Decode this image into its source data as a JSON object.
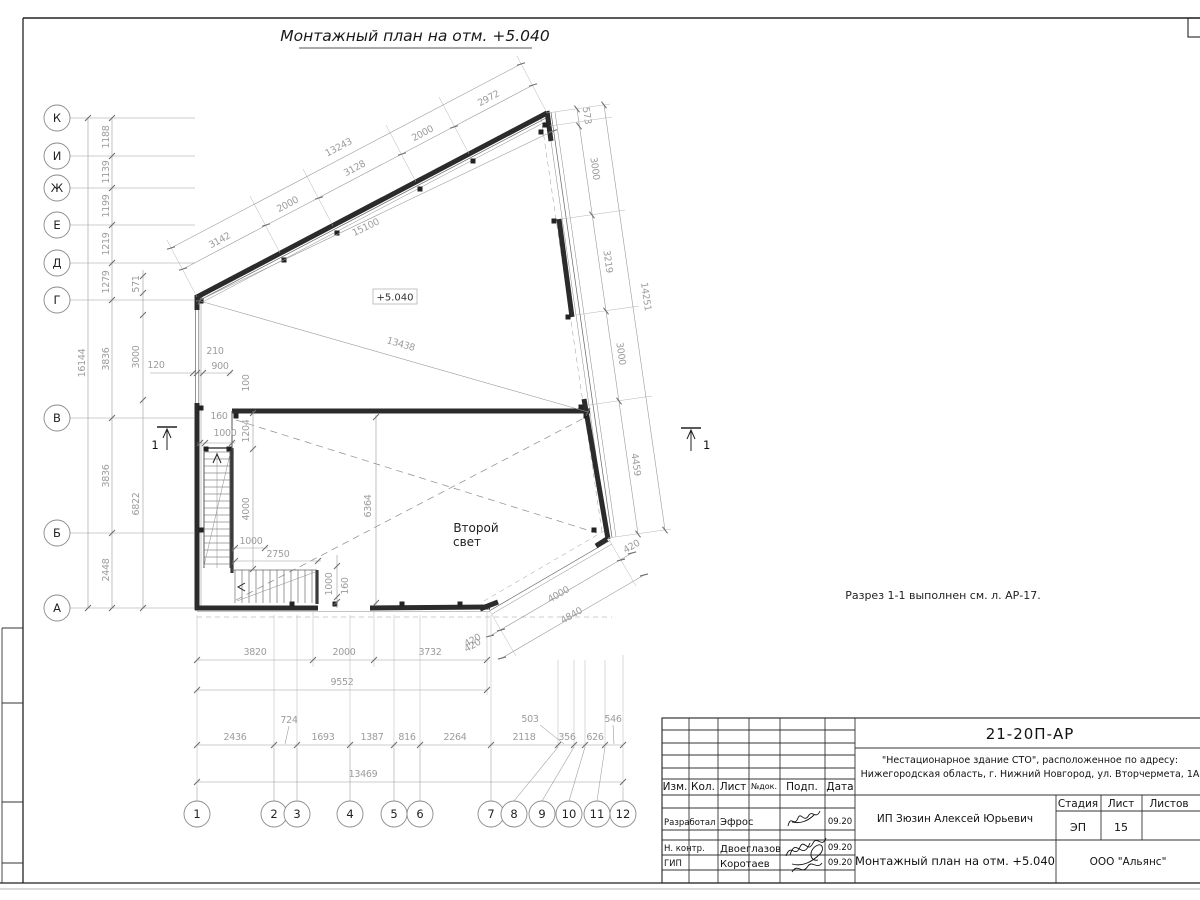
{
  "title": "Монтажный план на отм. +5.040",
  "note": "Разрез 1-1 выполнен см. л. АР-17.",
  "elev": "+5.040",
  "sec": "1",
  "room": {
    "l1": "Второй",
    "l2": "свет"
  },
  "axes": {
    "letters": [
      "К",
      "И",
      "Ж",
      "Е",
      "Д",
      "Г",
      "В",
      "Б",
      "А"
    ],
    "nums": [
      "1",
      "2",
      "3",
      "4",
      "5",
      "6",
      "7",
      "8",
      "9",
      "10",
      "11",
      "12"
    ]
  },
  "d": {
    "left": {
      "chain": [
        "1188",
        "1139",
        "1199",
        "1219",
        "1279",
        "3836",
        "3836",
        "2448"
      ],
      "total": "16144",
      "inner": [
        "571",
        "3000",
        "6822"
      ],
      "small": "120"
    },
    "top": {
      "chain": [
        "3142",
        "2000",
        "3128",
        "2000",
        "2972"
      ],
      "total": "13243",
      "diag": "15100",
      "diag2": "13438"
    },
    "right": {
      "chain": [
        "573",
        "3000",
        "3219",
        "3000",
        "4459"
      ],
      "total": "14251"
    },
    "chamfer": {
      "a": "420",
      "mid": "4000",
      "b": "420",
      "total": "4840"
    },
    "bottom": {
      "chain": [
        "3820",
        "2000",
        "3732"
      ],
      "small": "420",
      "total": "9552"
    },
    "grid": {
      "chain": [
        "2436",
        "724",
        "1693",
        "1387",
        "816",
        "2264",
        "2118",
        "503",
        "356",
        "626",
        "546"
      ],
      "total": "13469"
    },
    "stair": {
      "gap": "160",
      "width": "1000",
      "open": "1204",
      "run": "4000",
      "first": "1000",
      "run2": "2750",
      "off": "210",
      "win": "900",
      "small": "100",
      "below_w": "1000",
      "below_g": "160"
    },
    "room_h": "6364"
  },
  "tb": {
    "doc": "21-20П-АР",
    "proj1": "\"Нестационарное здание СТО\", расположенное по адресу:",
    "proj2": "Нижегородская область, г. Нижний Новгород, ул. Вторчермета, 1А",
    "cols": [
      "Изм.",
      "Кол.",
      "Лист",
      "№док.",
      "Подп.",
      "Дата"
    ],
    "r1": {
      "role": "Разработал",
      "name": "Эфрос",
      "date": "09.20"
    },
    "r2": {
      "role": "Н. контр.",
      "name": "Двоеглазов",
      "date": "09.20"
    },
    "r3": {
      "role": "ГИП",
      "name": "Коротаев",
      "date": "09.20"
    },
    "client": "ИП Зюзин Алексей Юрьевич",
    "stage_h": "Стадия",
    "sheet_h": "Лист",
    "sheets_h": "Листов",
    "stage": "ЭП",
    "sheet": "15",
    "doctitle": "Монтажный план на отм. +5.040",
    "company": "ООО \"Альянс\""
  }
}
